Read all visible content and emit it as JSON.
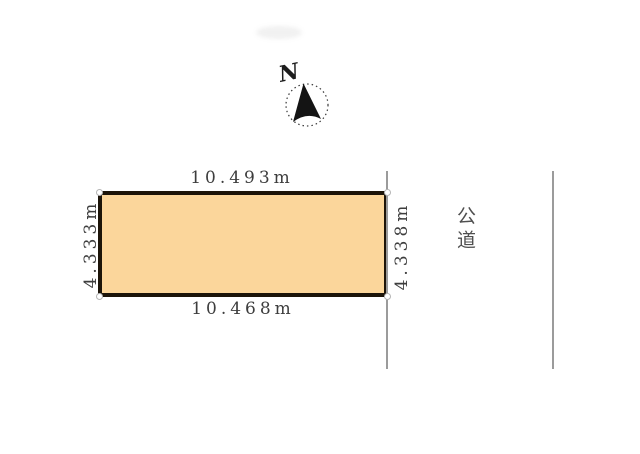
{
  "diagram": {
    "compass": {
      "label": "N"
    },
    "parcel": {
      "fill_color": "#FBD69B",
      "border_color": "#1c1409",
      "dimensions": {
        "top": "10.493m",
        "bottom": "10.468m",
        "left": "4.333m",
        "right": "4.338m"
      }
    },
    "road": {
      "label": "公道"
    },
    "colors": {
      "dimension_text": "#3d3d3d",
      "road_line": "#9b9b9b",
      "road_text": "#4f4f4f"
    }
  }
}
